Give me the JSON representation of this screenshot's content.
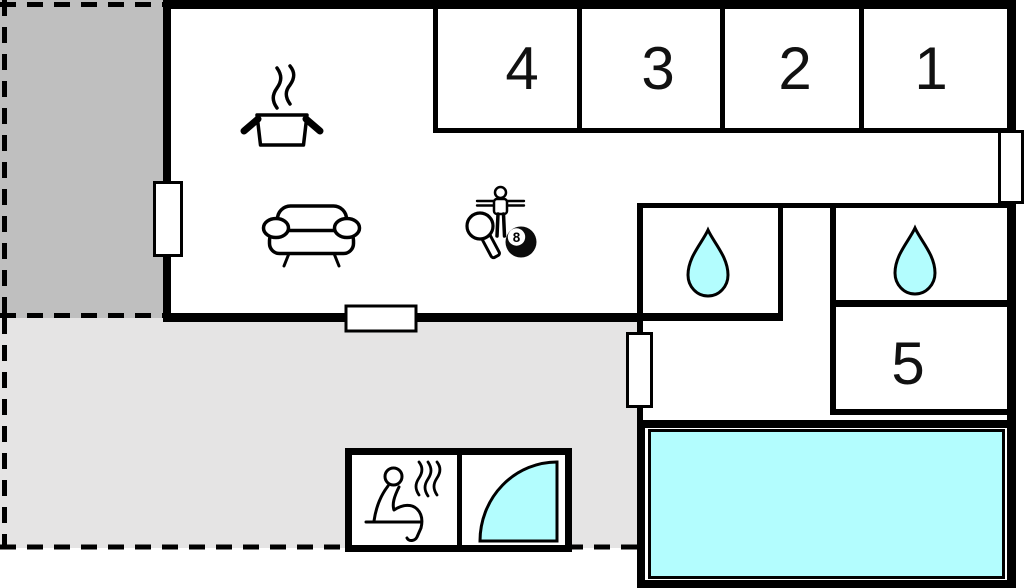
{
  "plan": {
    "type": "holiday-home-floor-plan",
    "rooms": [
      {
        "id": "bedroom-1",
        "label": "1"
      },
      {
        "id": "bedroom-2",
        "label": "2"
      },
      {
        "id": "bedroom-3",
        "label": "3"
      },
      {
        "id": "bedroom-4",
        "label": "4"
      },
      {
        "id": "room-5",
        "label": "5"
      }
    ],
    "billiard_ball": {
      "number": "8"
    },
    "features": [
      "cooking-pot-icon",
      "steam-icon",
      "sofa-icon",
      "foosball-player-icon",
      "table-tennis-paddle-icon",
      "billiard-8-ball-icon",
      "water-drop-icon",
      "water-drop-icon",
      "sauna-person-icon",
      "shower-quarter-icon",
      "swimming-pool"
    ],
    "areas": [
      "covered-terrace-dark",
      "open-terrace-light",
      "living-kitchen-area",
      "corridor",
      "bathroom-left",
      "bathroom-right",
      "sauna-cabin",
      "shower-cabin",
      "pool-deck"
    ],
    "colors": {
      "wall": "#000000",
      "floor": "#ffffff",
      "water": "#b3fdfe",
      "terrace_dark": "#bfbfbf",
      "terrace_light": "#e5e4e4",
      "steam_gray": "#9a9a9a"
    }
  }
}
